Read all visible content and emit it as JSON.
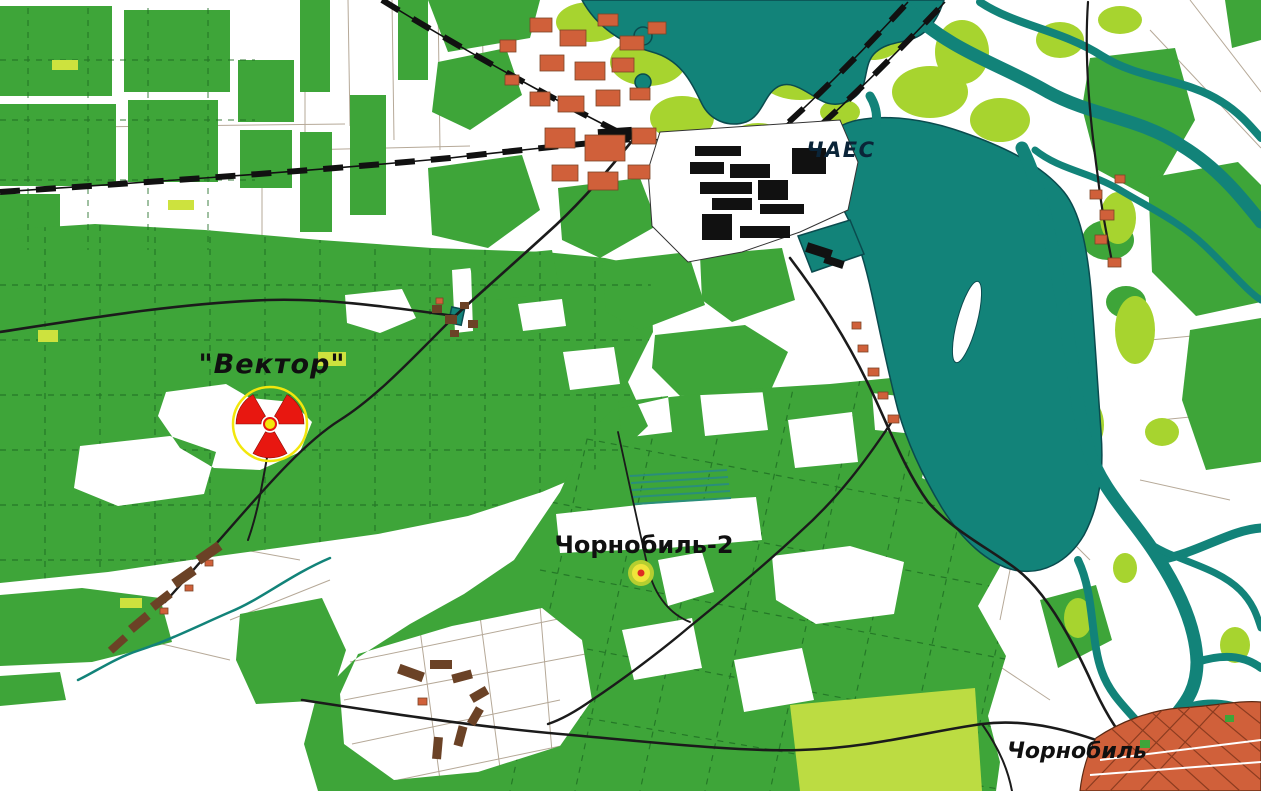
{
  "map": {
    "labels": {
      "vektor": "\"Вектор\"",
      "chaes": "ЧАЕС",
      "chornobyl2": "Чорнобиль-2",
      "chornobyl": "Чорнобиль"
    },
    "markers": {
      "vektor_site": {
        "symbol": "radiation-trefoil",
        "ring_color": "#f2e70c",
        "trefoil_color": "#e81710",
        "center_color": "#f2e70c"
      },
      "chornobyl2_site": {
        "symbol": "ringed-dot",
        "outer_color": "#b5ce30",
        "inner_color": "#f0e43a",
        "dot_color": "#df2b22"
      }
    },
    "colors": {
      "forest": "#3ea539",
      "meadow": "#a7d42f",
      "water": "#128379",
      "water_outline": "#0a4b4e",
      "built_up": "#d0603a",
      "built_up_dark": "#6b4226",
      "roads": "#1b1b1b",
      "background": "#ffffff"
    }
  }
}
